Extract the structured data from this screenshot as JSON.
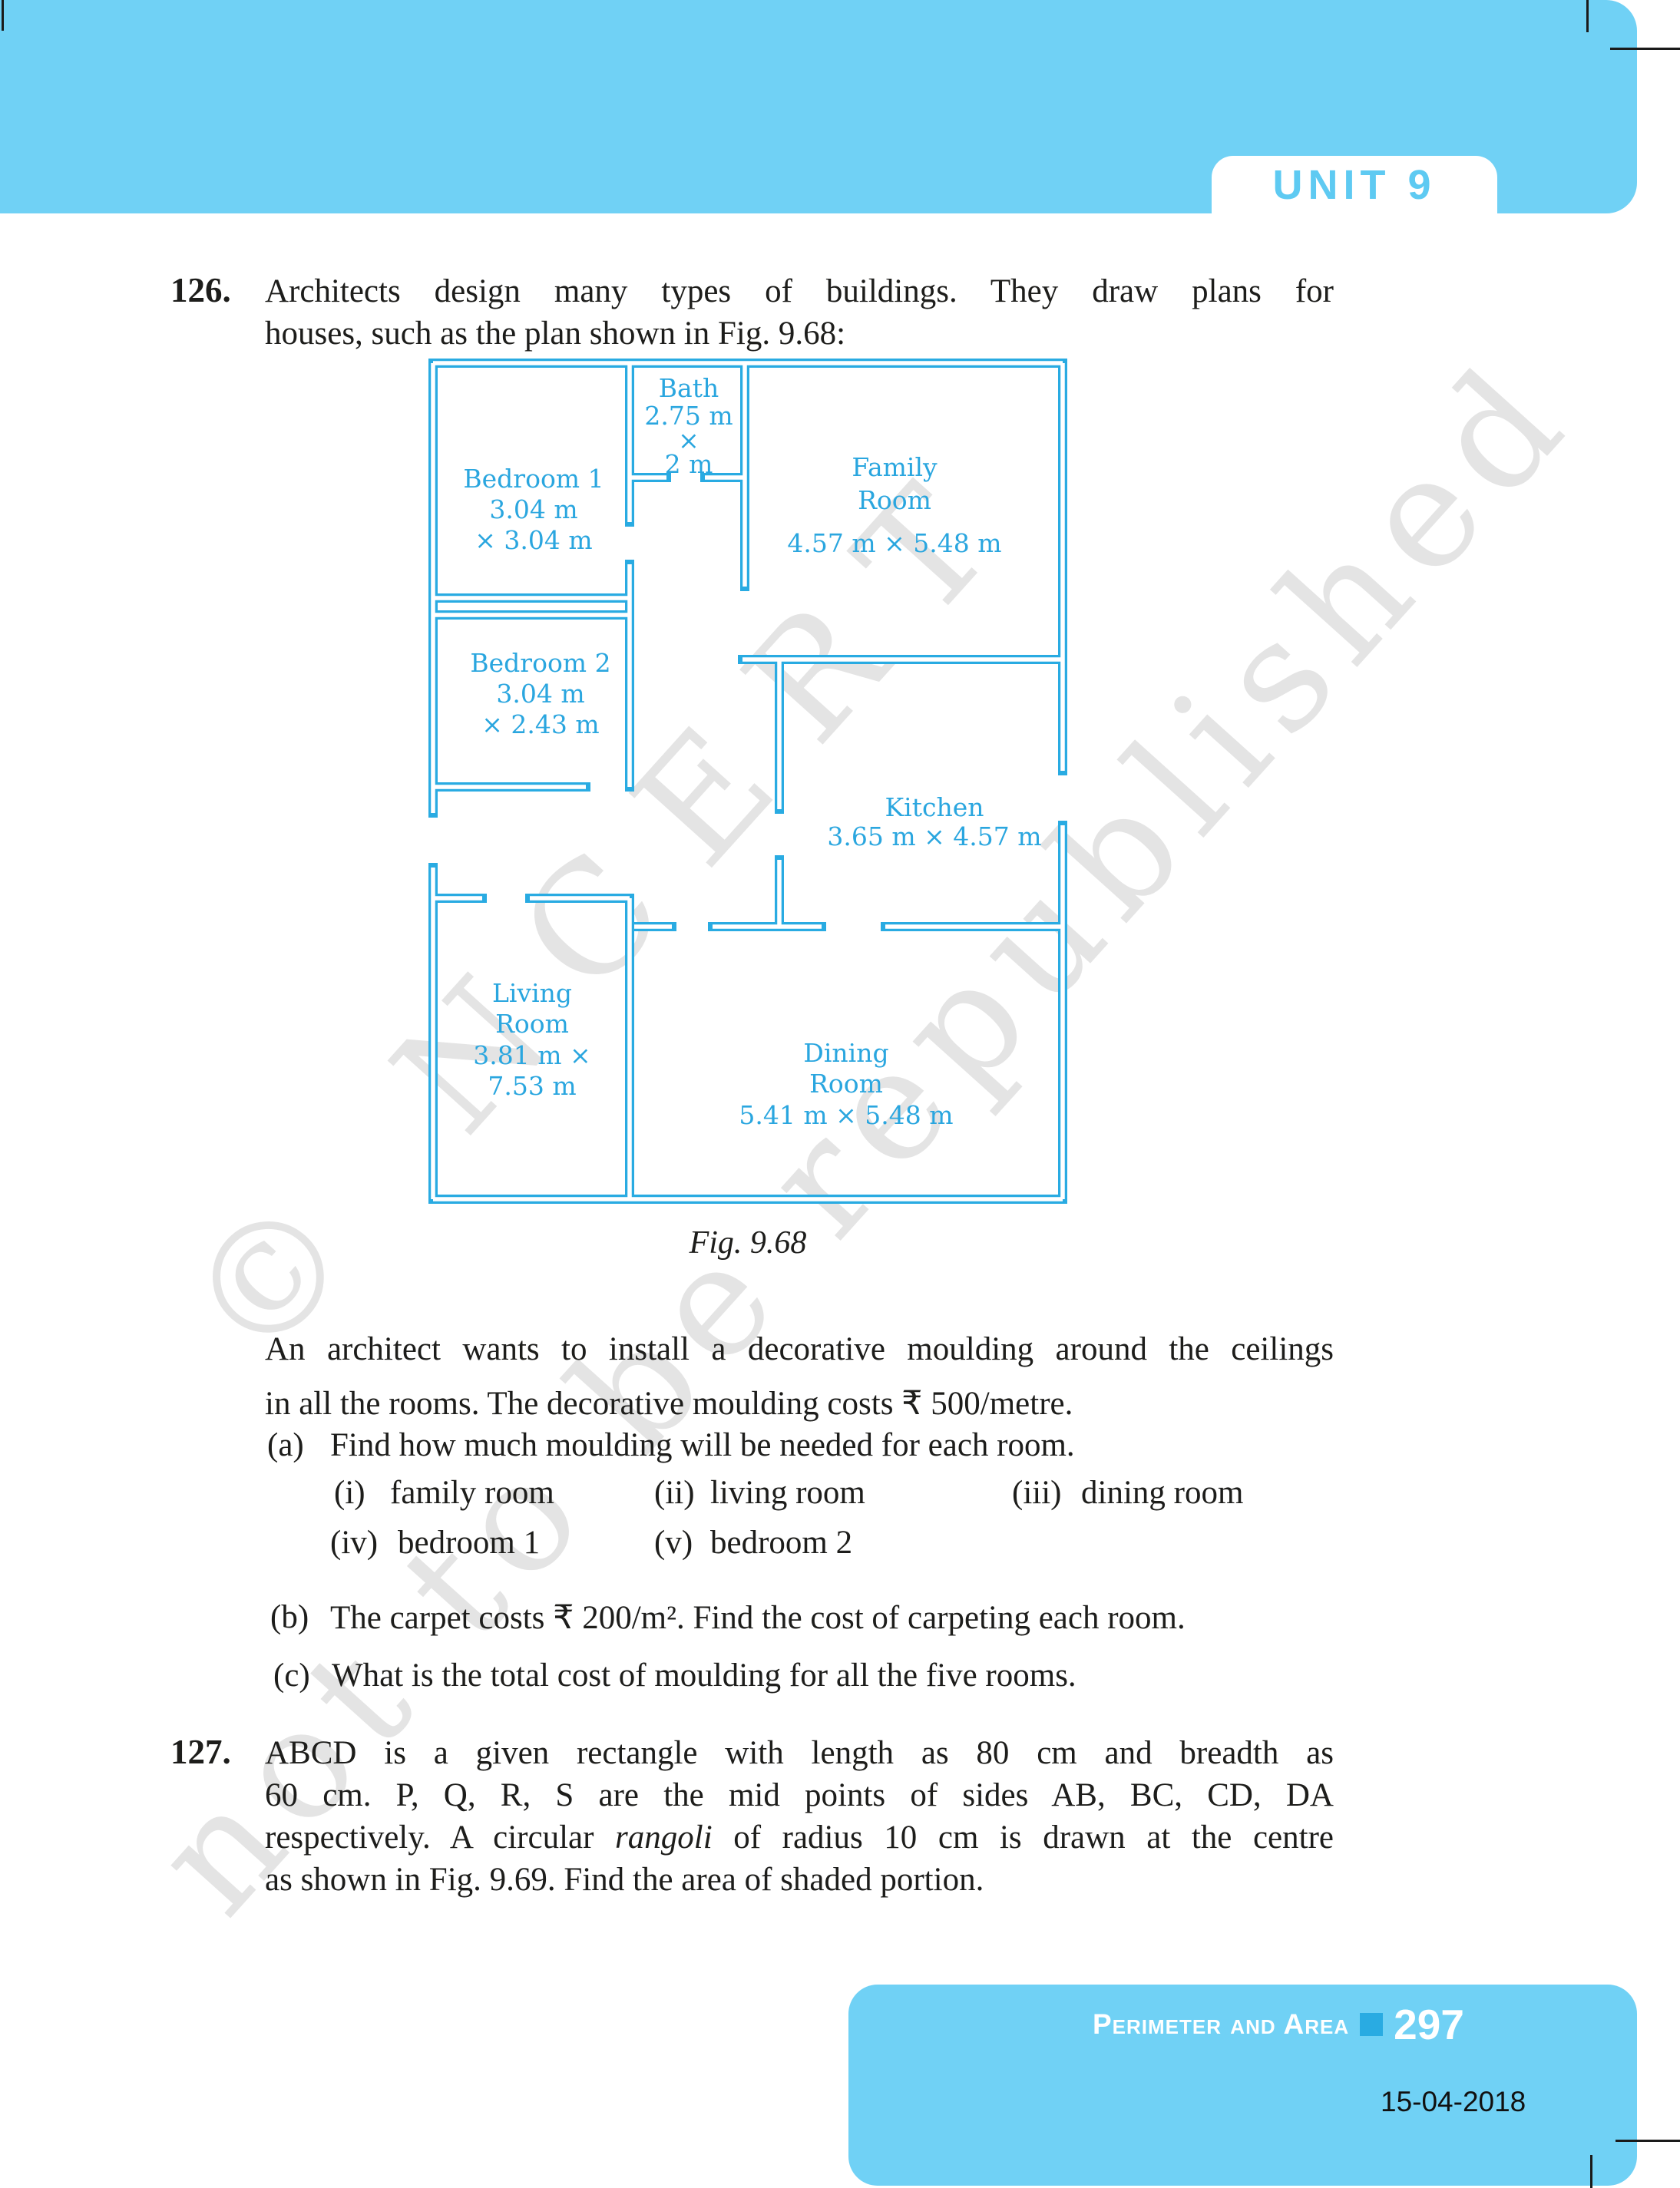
{
  "header": {
    "unit_label": "UNIT 9"
  },
  "q126": {
    "number": "126.",
    "lines": [
      "Architects design many types of buildings. They draw plans for",
      "houses, such as the plan shown in Fig. 9.68:"
    ]
  },
  "figure": {
    "caption": "Fig. 9.68",
    "rooms": [
      {
        "name": "bedroom-1",
        "lines": [
          "Bedroom 1",
          "3.04 m",
          "× 3.04 m"
        ]
      },
      {
        "name": "bath",
        "lines": [
          "Bath",
          "2.75 m",
          "×",
          "2 m"
        ]
      },
      {
        "name": "family-room",
        "lines": [
          "Family",
          "Room",
          "4.57 m × 5.48 m"
        ]
      },
      {
        "name": "bedroom-2",
        "lines": [
          "Bedroom 2",
          "3.04 m",
          "× 2.43 m"
        ]
      },
      {
        "name": "kitchen",
        "lines": [
          "Kitchen",
          "3.65 m × 4.57 m"
        ]
      },
      {
        "name": "living-room",
        "lines": [
          "Living",
          "Room",
          "3.81 m ×",
          "7.53 m"
        ]
      },
      {
        "name": "dining-room",
        "lines": [
          "Dining",
          "Room",
          "5.41 m × 5.48 m"
        ]
      }
    ]
  },
  "moulding": {
    "lines": [
      "An architect wants to install a decorative moulding around the ceilings",
      "in all the rooms. The decorative moulding costs ₹ 500/metre."
    ]
  },
  "parts": {
    "a": {
      "num": "(a)",
      "text": "Find how much moulding will be needed for each room."
    },
    "a_items_row1": [
      {
        "num": "(i)",
        "label": "family room"
      },
      {
        "num": "(ii)",
        "label": "living room"
      },
      {
        "num": "(iii)",
        "label": "dining room"
      }
    ],
    "a_items_row2": [
      {
        "num": "(iv)",
        "label": "bedroom 1"
      },
      {
        "num": "(v)",
        "label": "bedroom 2"
      }
    ],
    "b": {
      "num": "(b)",
      "text": "The carpet costs ₹ 200/m². Find the cost of carpeting each room."
    },
    "c": {
      "num": "(c)",
      "text": "What is the total cost of moulding for all the five rooms."
    }
  },
  "q127": {
    "number": "127.",
    "line1": "ABCD is a given rectangle with length as 80 cm and breadth as",
    "line2": "60 cm. P, Q, R, S are the mid points of sides AB, BC, CD, DA",
    "line3_pre": "respectively. A circular ",
    "line3_italic": "rangoli",
    "line3_post": " of radius 10 cm is drawn at the centre",
    "line4": "as shown in Fig. 9.69. Find the area of shaded portion."
  },
  "watermark": {
    "line1": "© NCERT",
    "line2": "not to be republished"
  },
  "footer": {
    "section": "Perimeter and Area",
    "page_number": "297",
    "date": "15-04-2018"
  },
  "colors": {
    "band_blue": "#70d1f5",
    "plan_blue": "#29abe2",
    "footer_square_blue": "#29abe2"
  }
}
